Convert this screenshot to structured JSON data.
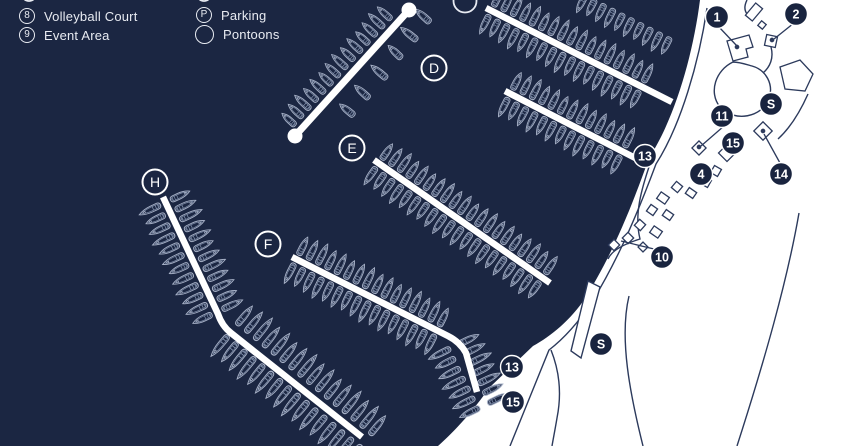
{
  "colors": {
    "water": "#1b2642",
    "land": "#ffffff",
    "outline": "#2c3a5c",
    "pontoon": "#ffffff",
    "boat": "#a6b0c6",
    "boat_detail": "#8291ad",
    "marker_fill": "#19243f",
    "marker_text": "#ffffff",
    "legend_text": "#e8ebf2"
  },
  "legend": {
    "items": [
      {
        "symbol": "8",
        "label": "Volleyball Court"
      },
      {
        "symbol": "9",
        "label": "Event Area"
      },
      {
        "symbol": "P",
        "label": "Parking"
      },
      {
        "symbol": "",
        "label": "Pontoons"
      }
    ]
  },
  "pontoon_labels": [
    {
      "letter": "D",
      "x": 434,
      "y": 68
    },
    {
      "letter": "E",
      "x": 352,
      "y": 148
    },
    {
      "letter": "F",
      "x": 268,
      "y": 244
    },
    {
      "letter": "H",
      "x": 155,
      "y": 182
    }
  ],
  "markers": [
    {
      "label": "1",
      "x": 717,
      "y": 17
    },
    {
      "label": "2",
      "x": 796,
      "y": 14
    },
    {
      "label": "11",
      "x": 722,
      "y": 116
    },
    {
      "label": "S",
      "x": 771,
      "y": 104
    },
    {
      "label": "15",
      "x": 733,
      "y": 143
    },
    {
      "label": "13",
      "x": 645,
      "y": 156
    },
    {
      "label": "4",
      "x": 701,
      "y": 174
    },
    {
      "label": "14",
      "x": 781,
      "y": 174
    },
    {
      "label": "10",
      "x": 662,
      "y": 257
    },
    {
      "label": "S",
      "x": 601,
      "y": 344
    },
    {
      "label": "13",
      "x": 512,
      "y": 367
    },
    {
      "label": "15",
      "x": 513,
      "y": 402
    }
  ]
}
